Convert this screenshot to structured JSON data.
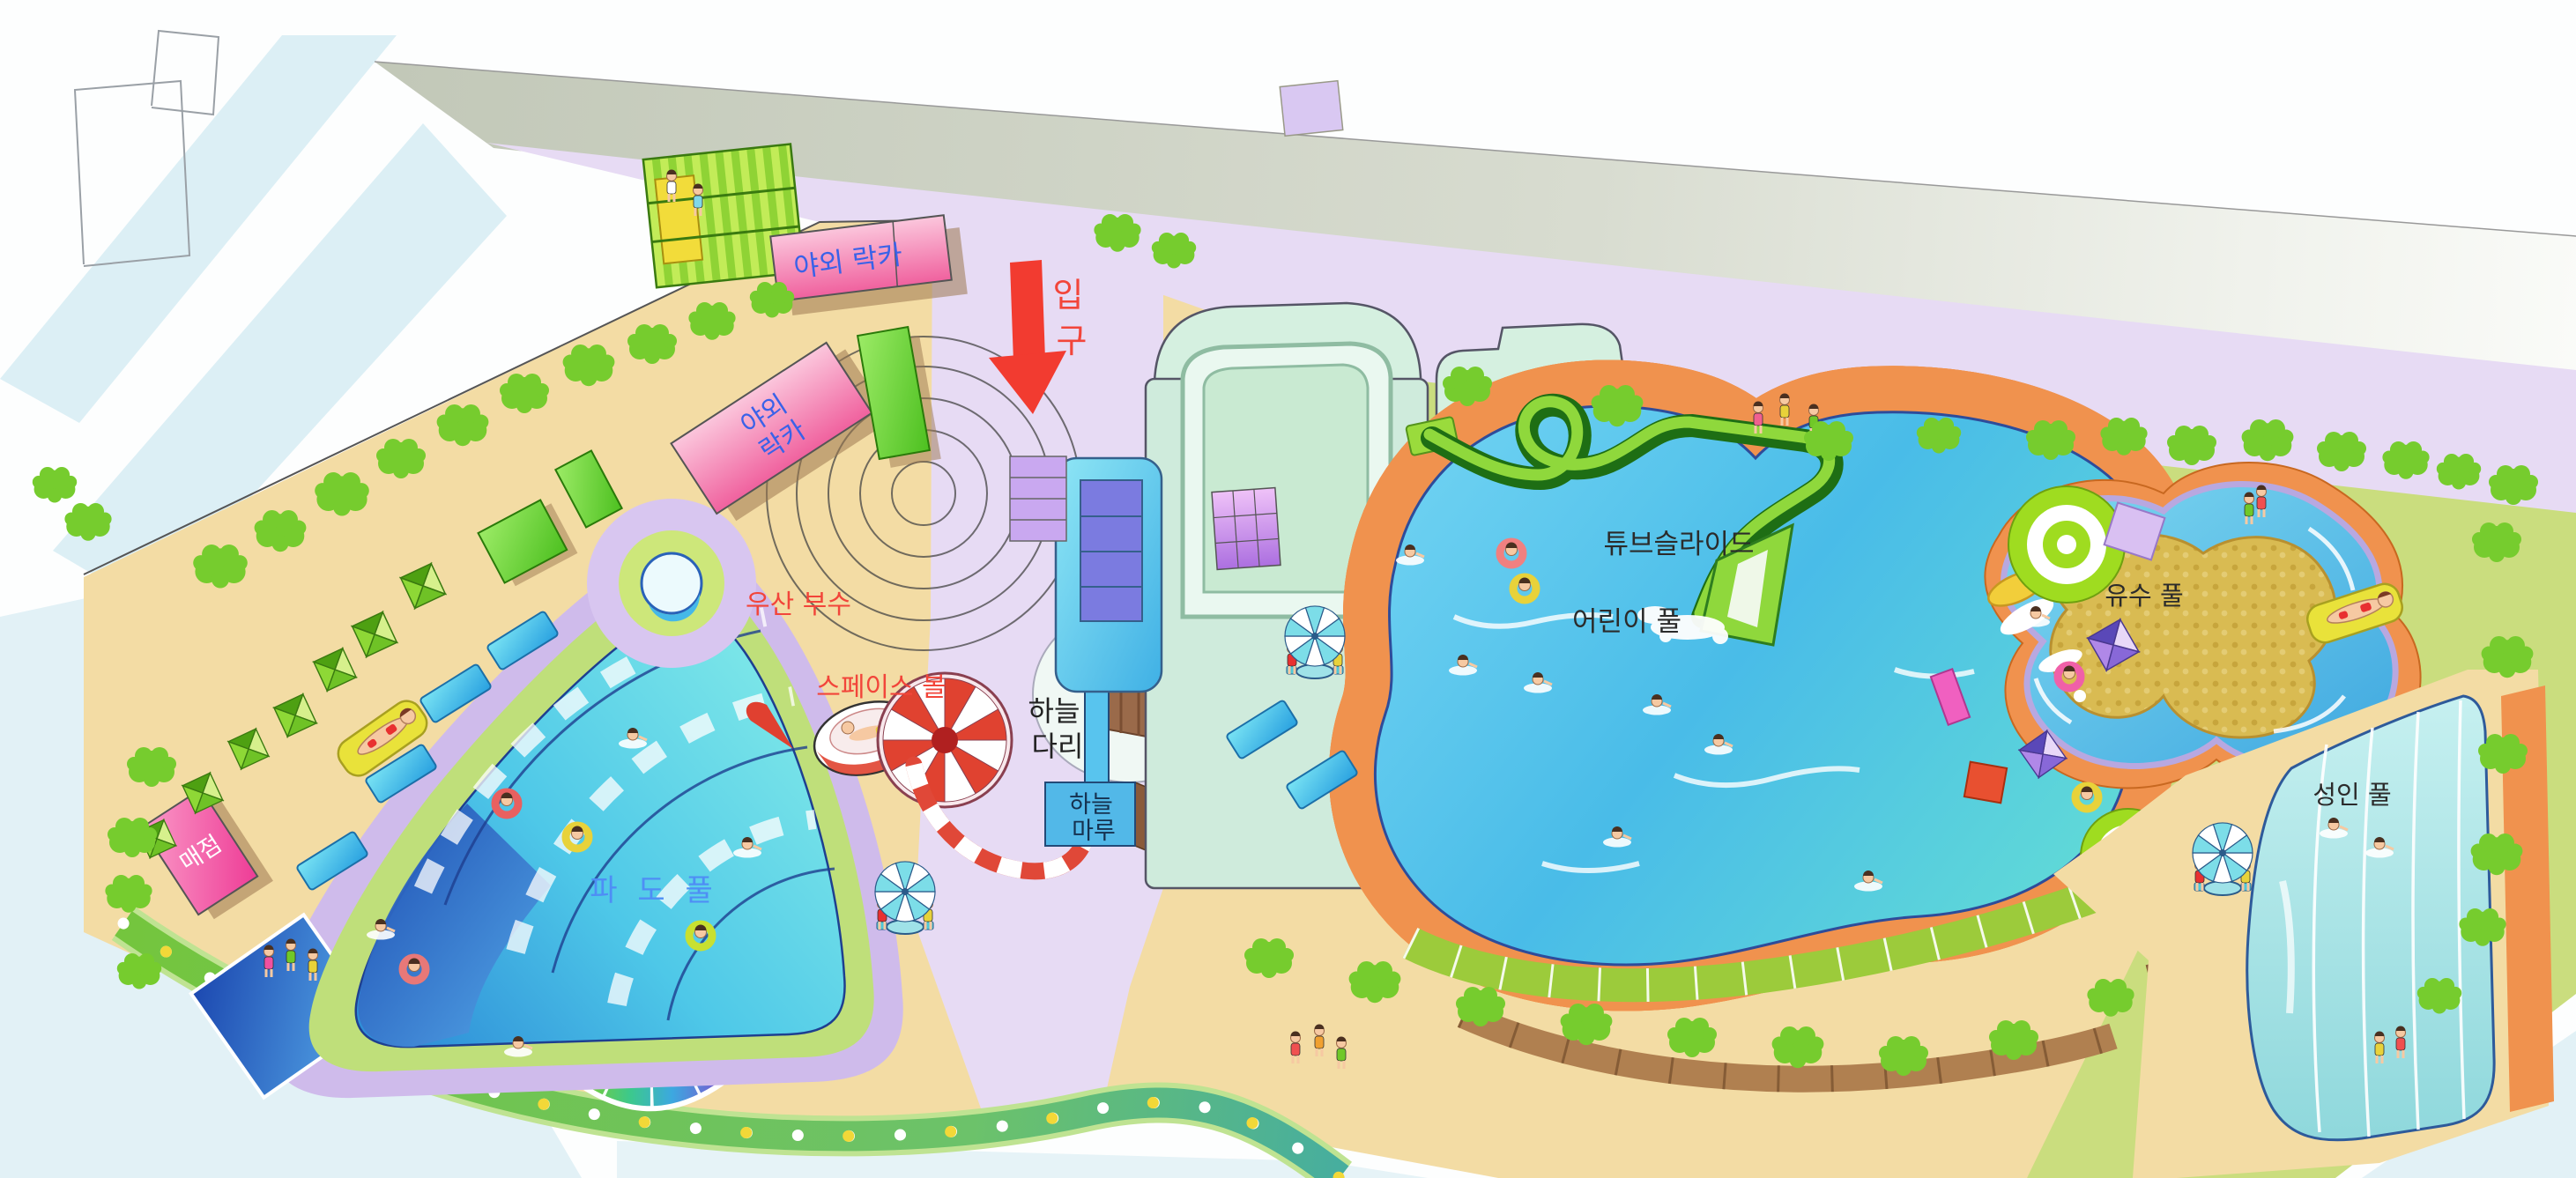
{
  "map": {
    "labels": {
      "entrance": "입구",
      "entrance_line1": "입",
      "entrance_line2": "구",
      "outdoor_locker_top": "야외 락카",
      "outdoor_locker_side_line1": "야외",
      "outdoor_locker_side_line2": "락카",
      "umbrella_fountain": "우산 부수",
      "space_ball": "스페이스 볼",
      "sky_bridge_line1": "하늘",
      "sky_bridge_line2": "다리",
      "sky_maru_line1": "하늘",
      "sky_maru_line2": "마루",
      "wave_pool": "파 도 풀",
      "snack_bar": "매점",
      "rainbow_village": "레인보우 빌리지",
      "tube_slide": "튜브슬라이드",
      "children_pool": "어린이 풀",
      "lazy_river_pool": "유수 풀",
      "adult_pool": "성인 풀"
    },
    "label_colors": {
      "blue": "#3A62E8",
      "red": "#F2453A",
      "black": "#2B2B2B",
      "white": "#FFFFFF"
    },
    "palette": {
      "sand": "#F3DCA4",
      "grass": "#CADD7E",
      "walkway": "#E7DBF4",
      "road_gray": "#C8CDC0",
      "tree_green": "#76CC2E",
      "pool_water": "#59C7EE",
      "deck_orange": "#F0924E",
      "rim_purple": "#AC9EDB",
      "building_pink": "#F27BAE",
      "building_mint": "#D5F0E0",
      "slide_green": "#2E7D1F",
      "stripe_red": "#E04838"
    }
  }
}
